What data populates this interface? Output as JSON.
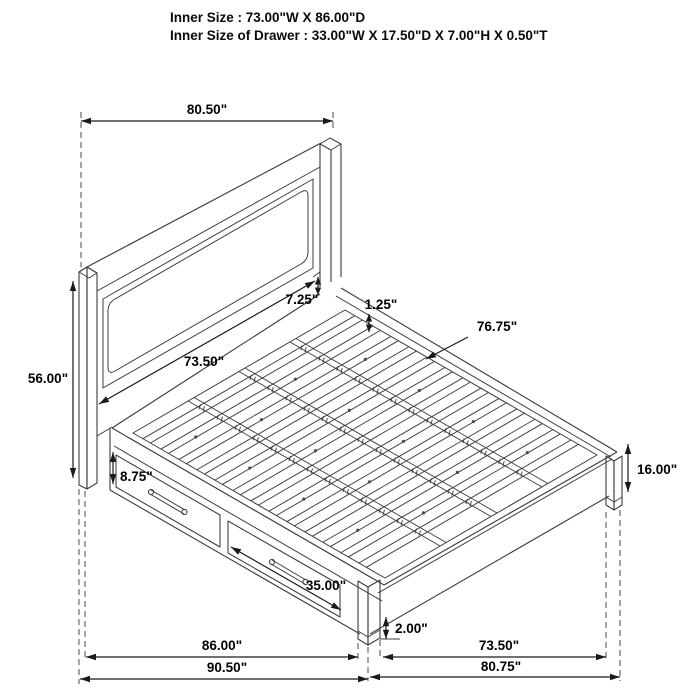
{
  "header": {
    "line1": "Inner Size : 73.00\"W X 86.00\"D",
    "line2": "Inner Size of Drawer : 33.00\"W X 17.50\"D X 7.00\"H X 0.50\"T"
  },
  "drawing": {
    "stroke_color": "#3c3c3c",
    "hidden_line_color": "#5a5a5a",
    "dimension_color": "#1a1a1a",
    "background": "#ffffff"
  },
  "dimensions": [
    {
      "id": "headboard-width",
      "label": "80.50\""
    },
    {
      "id": "headboard-height",
      "label": "56.00\""
    },
    {
      "id": "headboard-rail-gap",
      "label": "7.25\""
    },
    {
      "id": "slat-thickness",
      "label": "1.25\""
    },
    {
      "id": "slat-deck-length",
      "label": "76.75\""
    },
    {
      "id": "headboard-panel-width",
      "label": "73.50\""
    },
    {
      "id": "drawer-front-height",
      "label": "8.75\""
    },
    {
      "id": "drawer-front-width",
      "label": "35.00\""
    },
    {
      "id": "footboard-height",
      "label": "16.00\""
    },
    {
      "id": "floor-clearance",
      "label": "2.00\""
    },
    {
      "id": "side-rail-length",
      "label": "86.00\""
    },
    {
      "id": "overall-depth",
      "label": "90.50\""
    },
    {
      "id": "foot-inner-width",
      "label": "73.50\""
    },
    {
      "id": "overall-foot-width",
      "label": "80.75\""
    }
  ]
}
